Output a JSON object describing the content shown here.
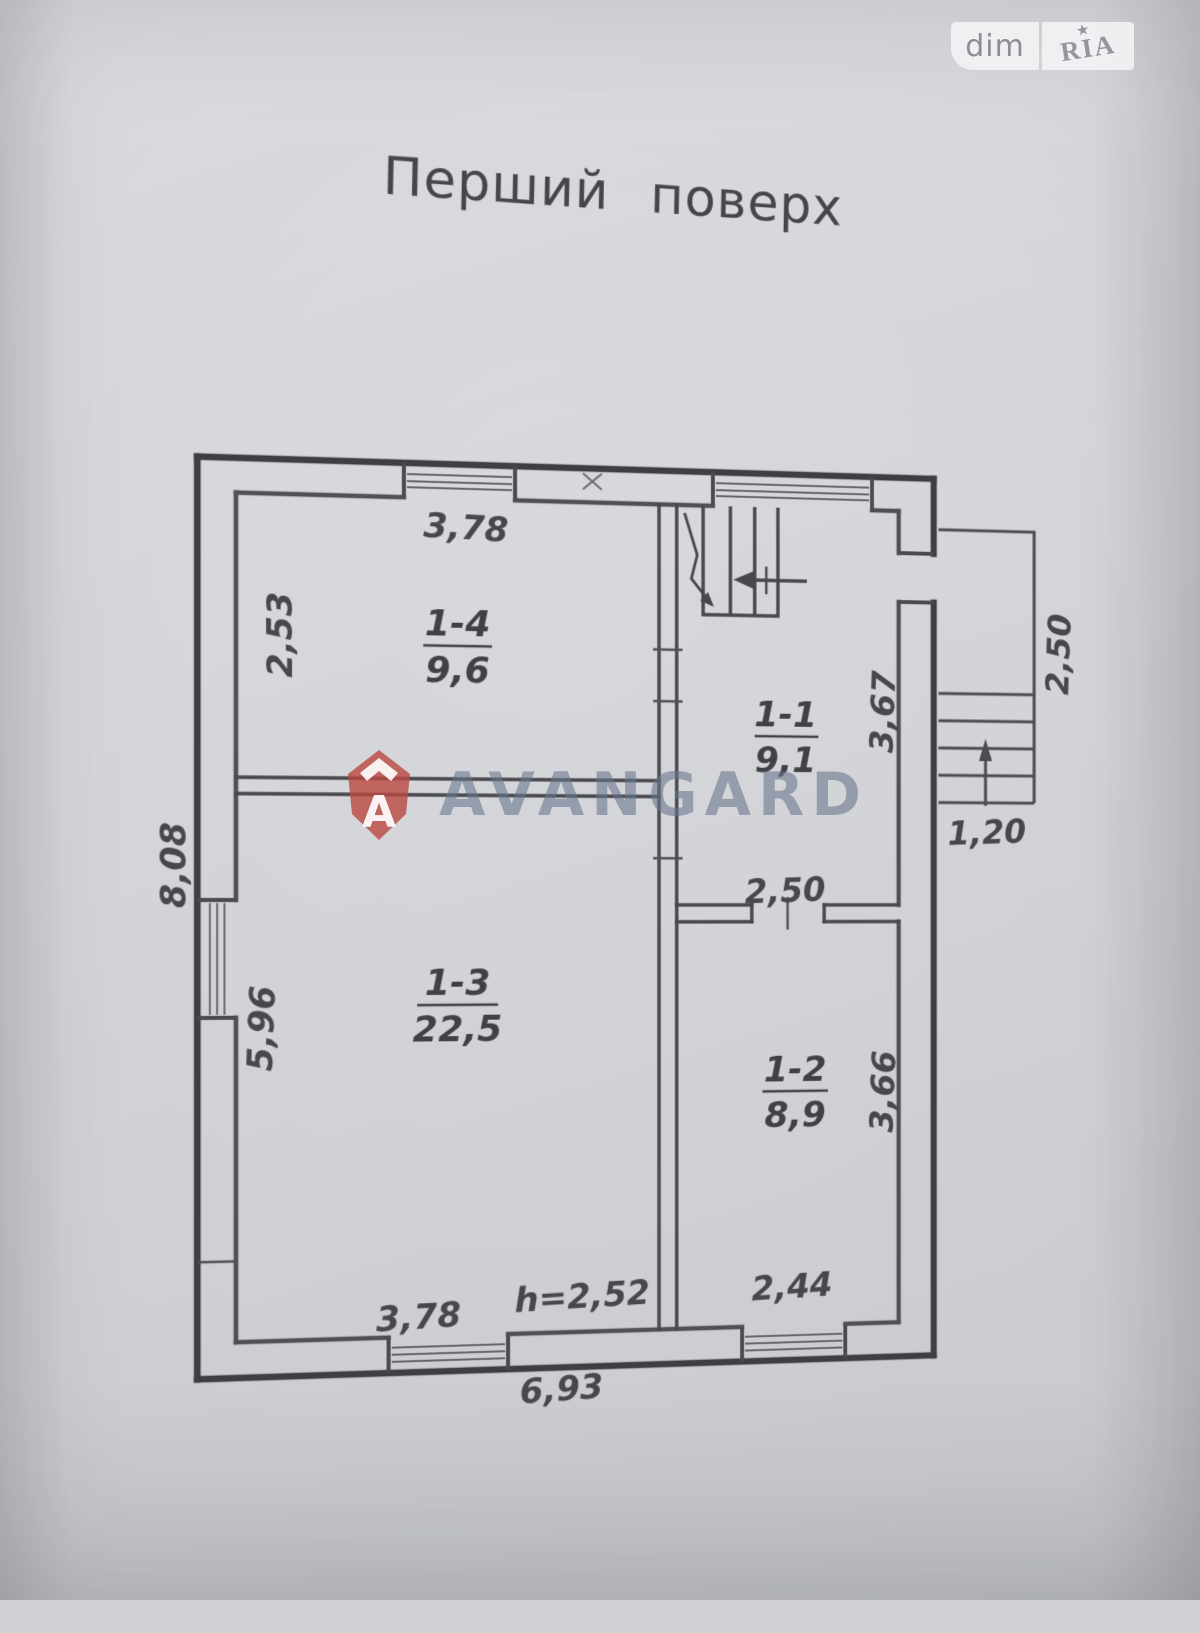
{
  "title": "Перший поверх",
  "photo_badge": {
    "left_label": "dim",
    "right_label": "RIA"
  },
  "watermark": {
    "text": "AVANGARD",
    "logo_letter": "A",
    "logo_color": "#b9473f",
    "text_color": "#68768c"
  },
  "plan": {
    "ink_color": "#3e3f43",
    "rooms": [
      {
        "id": "1-4",
        "area": "9,6"
      },
      {
        "id": "1-1",
        "area": "9,1"
      },
      {
        "id": "1-3",
        "area": "22,5"
      },
      {
        "id": "1-2",
        "area": "8,9"
      }
    ],
    "dims": {
      "room14_width": "3,78",
      "room14_depth": "2,53",
      "left_side_total": "8,08",
      "room13_depth": "5,96",
      "room13_width": "3,78",
      "ceiling_height": "h=2,52",
      "bottom_total": "6,93",
      "room12_window": "2,44",
      "room11_12_opening": "2,50",
      "room11_depth": "3,67",
      "room12_depth": "3,66",
      "porch_depth": "2,50",
      "porch_width": "1,20"
    }
  }
}
